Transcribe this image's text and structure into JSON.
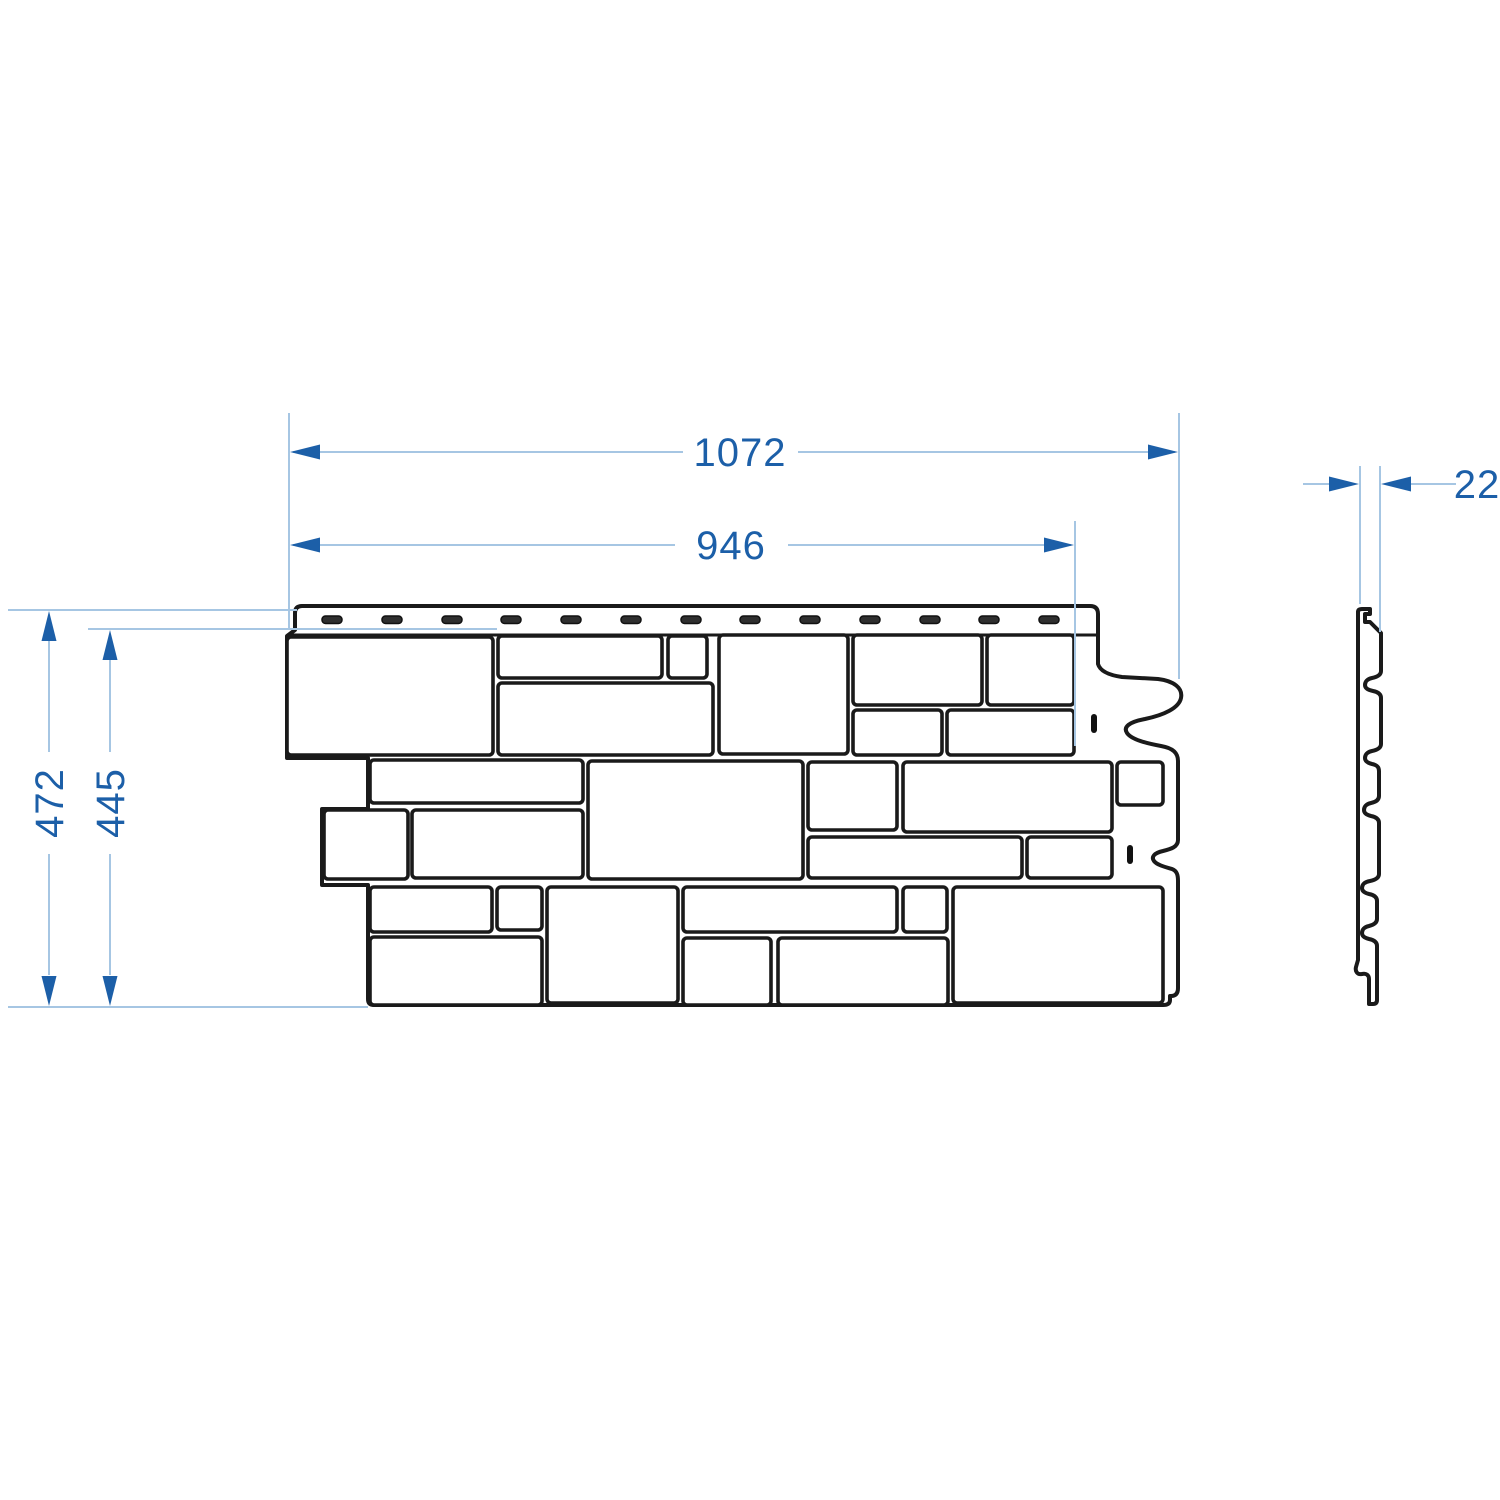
{
  "drawing": {
    "type": "technical-dimension-drawing",
    "views": 2
  },
  "dimensions": {
    "overall_width": "1072",
    "working_width": "946",
    "overall_height": "472",
    "working_height": "445",
    "thickness": "22"
  },
  "colors": {
    "background": "#ffffff",
    "panel_outline": "#1a1a1a",
    "dimension_accent": "#1c5fa8",
    "dimension_line": "#a6c6e3",
    "slot_fill": "#2f2f2f"
  },
  "counts": {
    "nail_slots": 13,
    "bricks": 27
  }
}
